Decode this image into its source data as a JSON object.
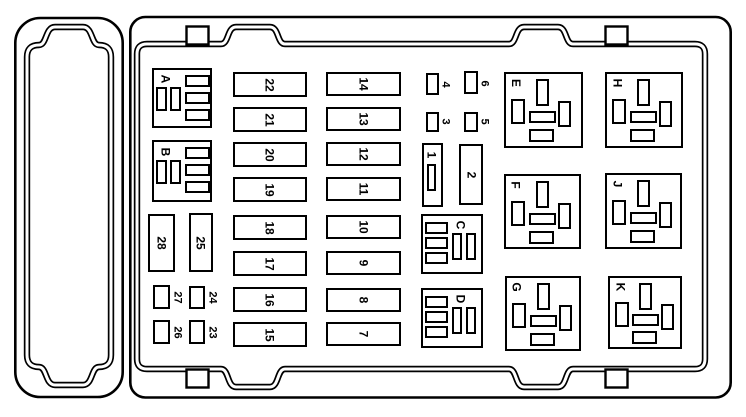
{
  "colors": {
    "line": "#000000",
    "background": "#ffffff"
  },
  "blocks": {
    "a": "A",
    "b": "B",
    "c": "C",
    "d": "D"
  },
  "relays": {
    "e": "E",
    "h": "H",
    "f": "F",
    "j": "J",
    "g": "G",
    "k": "K"
  },
  "fuses": {
    "col1": [
      "22",
      "21",
      "20",
      "19",
      "18",
      "17",
      "16",
      "15"
    ],
    "col2": [
      "14",
      "13",
      "12",
      "11",
      "10",
      "9",
      "8",
      "7"
    ],
    "f28": "28",
    "f25": "25",
    "f27": "27",
    "f24": "24",
    "f26": "26",
    "f23": "23",
    "f4": "4",
    "f6": "6",
    "f3": "3",
    "f5": "5",
    "f1": "1",
    "f2": "2"
  }
}
